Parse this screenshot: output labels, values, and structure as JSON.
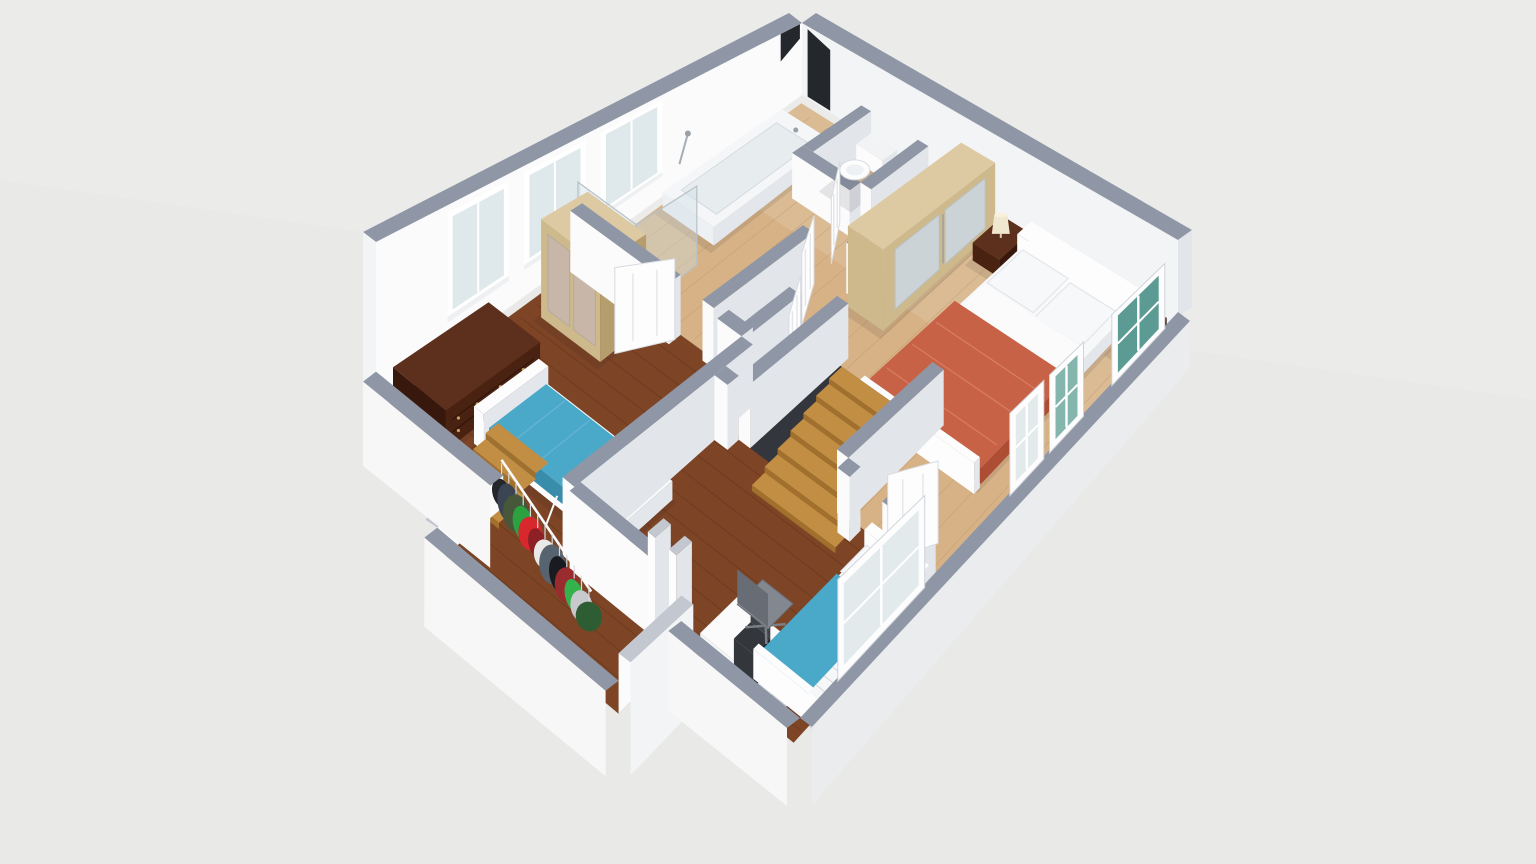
{
  "scene": {
    "kind": "isometric-3d-floorplan-render",
    "floor_label": "upper floor",
    "rooms": [
      "bathroom",
      "hallway",
      "master-bedroom",
      "bedroom-left",
      "kids-bedroom",
      "walk-in-closet",
      "staircase"
    ],
    "furniture": [
      "bathtub",
      "shower-enclosure",
      "toilet",
      "mirrored-wardrobe-master",
      "mirrored-wardrobe-left",
      "double-bed-orange",
      "nightstand-left",
      "nightstand-right",
      "table-lamp",
      "single-bed-blue-left",
      "single-bed-blue-kids",
      "mahogany-dresser",
      "clothes-rail",
      "hanging-clothes",
      "desk",
      "laptop",
      "office-chair",
      "radiator",
      "wooden-staircase",
      "small-steps"
    ]
  },
  "colors": {
    "background": "#e9e9e8",
    "backgroundLight": "#ececeb",
    "wallLit": "#fbfbfc",
    "wallMid": "#f3f4f6",
    "wallSide": "#e2e5ea",
    "wallCap": "#8f97a6",
    "wallCapLight": "#c2c7d0",
    "slabSide": "#f7f7f8",
    "slabSideDark": "#ebecee",
    "darkOpening": "#24272c",
    "oak": "#d7b286",
    "oakLine": "#b8925f",
    "oakWash": "#ffffff",
    "walnut": "#7d4526",
    "walnutLine": "#5f3015",
    "stair": "#c28e44",
    "stairRiser": "#a0702c",
    "stairHole": "#33363d",
    "glassPale": "#dfe8ea",
    "glassTeal": "#4e938a",
    "glassTeal2": "#79b0a6",
    "mirror": "#ccd3d6",
    "mirrorTint": "#c8b7a8",
    "woodLight": "#ddcaa2",
    "woodLightFace": "#cdb98b",
    "woodLightSide": "#b69d6d",
    "mahoganyTop": "#5d2f1d",
    "mahoganyFace": "#4a2212",
    "mahoganySide": "#38180c",
    "bedBlue": "#4aa8c9",
    "bedBlueDark": "#3a8cab",
    "bedBlueFold": "#6fb9d2",
    "orange": "#c86247",
    "orangeDark": "#ad4d33",
    "orangeFold": "#d88166",
    "linen": "#f7f8f9",
    "linenShade": "#e3e6ea",
    "chair": "#83878f",
    "chairDark": "#686c74",
    "laptop": "#33363b",
    "laptopScreen": "#3e4248",
    "lampCream": "#f0e7cf",
    "lampTop": "#f7f1de",
    "railWhite": "#fbfbfc",
    "knob": "#caa05c",
    "doorFace": "#fdfdfe",
    "doorEdge": "#d8dbe0",
    "doorPanel": "#e3e6ea",
    "clothes": [
      "#23262b",
      "#3a4452",
      "#47583a",
      "#2ba23f",
      "#d8282e",
      "#8c2024",
      "#e9e9e7",
      "#57636e",
      "#191b20",
      "#9a2c30",
      "#36b24c",
      "#c7c9cc",
      "#2e5d34",
      "#d4d4d2"
    ]
  }
}
